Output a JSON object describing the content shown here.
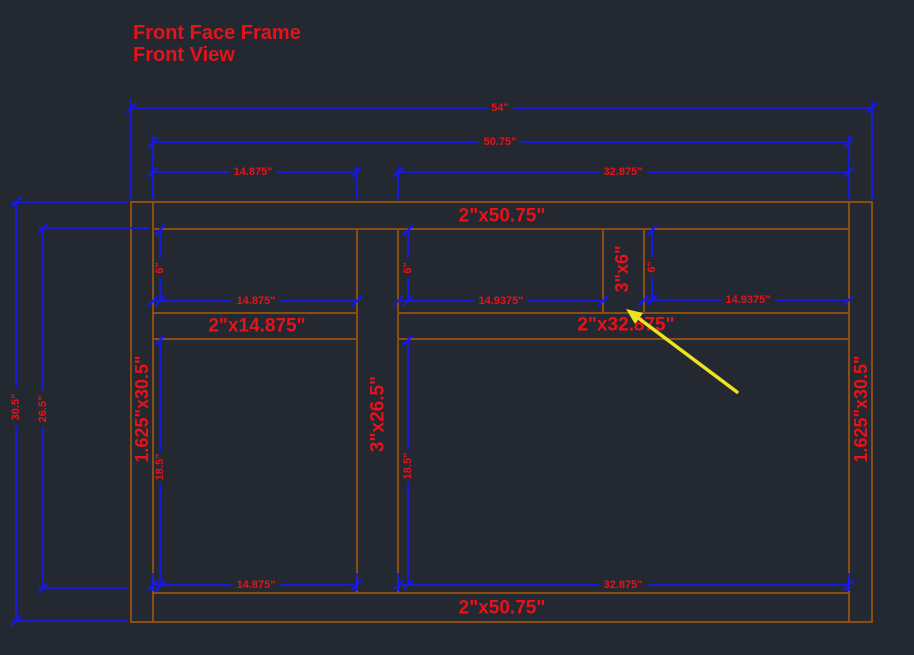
{
  "drawing": {
    "title_line1": "Front Face Frame",
    "title_line2": "Front View"
  },
  "colors": {
    "background": "#232831",
    "frame_lines": "#8a4e14",
    "dimension_lines": "#1418f2",
    "text_red": "#e8121a",
    "arrow_yellow": "#ede321"
  },
  "parts": {
    "top_rail": "2\"x50.75\"",
    "bottom_rail": "2\"x50.75\"",
    "left_mid_rail": "2\"x14.875\"",
    "right_mid_rail": "2\"x32.875\"",
    "left_stile": "1.625\"x30.5\"",
    "right_stile": "1.625\"x30.5\"",
    "center_stile": "3\"x26.5\"",
    "header_stile": "3\"x6\""
  },
  "dims": {
    "overall_width": "54\"",
    "inner_width": "50.75\"",
    "left_opening_top": "14.875\"",
    "right_opening_top": "32.875\"",
    "overall_height": "30.5\"",
    "opening_height": "26.5\"",
    "drawer_height_left": "6\"",
    "drawer_height_center": "6\"",
    "drawer_height_right": "6\"",
    "left_opening_mid": "14.875\"",
    "right_drawer_left": "14.9375\"",
    "right_drawer_right": "14.9375\"",
    "door_height_left": "18.5\"",
    "door_height_right": "18.5\"",
    "left_opening_bottom": "14.875\"",
    "right_opening_bottom": "32.875\""
  }
}
